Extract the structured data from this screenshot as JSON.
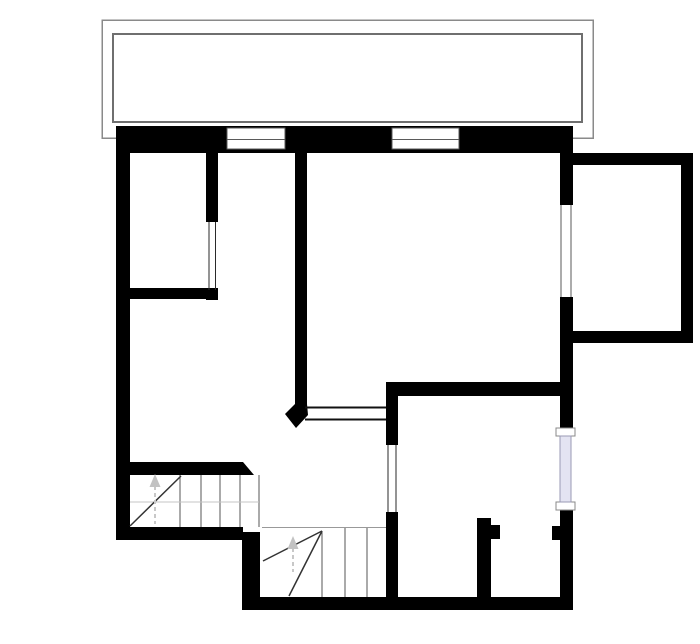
{
  "document": {
    "kind": "floor-plan-drawing",
    "canvas": {
      "width": 700,
      "height": 644
    }
  },
  "colors": {
    "wall": "#000000",
    "background": "#ffffff",
    "balcony_outline_outer": "#8a8a8a",
    "balcony_outline_inner": "#6f6f6f",
    "window_frame_line": "#5a5a5a",
    "opening_line": "#2a2a2a",
    "stair_tread_line": "#555555",
    "stair_diagonal_line": "#333333",
    "guide_line": "#c4c4c4",
    "arrow": "#c2c2c2",
    "glass_fill": "#e4e4f2",
    "glass_border": "#9a9ab4",
    "white": "#ffffff"
  },
  "plan": {
    "shapes": [
      {
        "type": "rect",
        "name": "balcony-outer-outline",
        "x": 102,
        "y": 20,
        "w": 491,
        "h": 118,
        "fill": "none",
        "stroke": "#8a8a8a",
        "sw": 1.5
      },
      {
        "type": "rect",
        "name": "balcony-inner-outline",
        "x": 113,
        "y": 34,
        "w": 469,
        "h": 88,
        "fill": "none",
        "stroke": "#6f6f6f",
        "sw": 2
      },
      {
        "type": "rect",
        "name": "wall-top-exterior",
        "x": 116,
        "y": 126,
        "w": 457,
        "h": 27,
        "fill": "#000000"
      },
      {
        "type": "rect",
        "name": "wall-left-exterior",
        "x": 116,
        "y": 126,
        "w": 14,
        "h": 414,
        "fill": "#000000"
      },
      {
        "type": "rect",
        "name": "wall-bottom-left",
        "x": 116,
        "y": 527,
        "w": 127,
        "h": 13,
        "fill": "#000000"
      },
      {
        "type": "rect",
        "name": "wall-stair-drop",
        "x": 242,
        "y": 532,
        "w": 18,
        "h": 78,
        "fill": "#000000"
      },
      {
        "type": "rect",
        "name": "wall-bottom-lower",
        "x": 242,
        "y": 597,
        "w": 331,
        "h": 13,
        "fill": "#000000"
      },
      {
        "type": "rect",
        "name": "wall-right-upper",
        "x": 560,
        "y": 153,
        "w": 13,
        "h": 52,
        "fill": "#000000"
      },
      {
        "type": "rect",
        "name": "wall-right-middle",
        "x": 560,
        "y": 297,
        "w": 13,
        "h": 131,
        "fill": "#000000"
      },
      {
        "type": "rect",
        "name": "wall-right-lower",
        "x": 560,
        "y": 510,
        "w": 13,
        "h": 100,
        "fill": "#000000"
      },
      {
        "type": "rect",
        "name": "wall-extension-top",
        "x": 573,
        "y": 153,
        "w": 120,
        "h": 12,
        "fill": "#000000"
      },
      {
        "type": "rect",
        "name": "wall-extension-right",
        "x": 681,
        "y": 153,
        "w": 12,
        "h": 190,
        "fill": "#000000"
      },
      {
        "type": "rect",
        "name": "wall-extension-bottom",
        "x": 573,
        "y": 331,
        "w": 120,
        "h": 12,
        "fill": "#000000"
      },
      {
        "type": "rect",
        "name": "wall-topleft-room-right",
        "x": 206,
        "y": 153,
        "w": 12,
        "h": 69,
        "fill": "#000000"
      },
      {
        "type": "rect",
        "name": "wall-topleft-room-bottom",
        "x": 128,
        "y": 288,
        "w": 90,
        "h": 11,
        "fill": "#000000"
      },
      {
        "type": "rect",
        "name": "wall-topleft-room-endcap",
        "x": 206,
        "y": 288,
        "w": 12,
        "h": 12,
        "fill": "#000000"
      },
      {
        "type": "rect",
        "name": "wall-central",
        "x": 295,
        "y": 153,
        "w": 12,
        "h": 252,
        "fill": "#000000"
      },
      {
        "type": "rect",
        "name": "wall-bottomright-room-top",
        "x": 386,
        "y": 382,
        "w": 187,
        "h": 14,
        "fill": "#000000"
      },
      {
        "type": "rect",
        "name": "wall-bottomright-left-upper",
        "x": 386,
        "y": 396,
        "w": 12,
        "h": 49,
        "fill": "#000000"
      },
      {
        "type": "rect",
        "name": "wall-bottomright-left-lower",
        "x": 386,
        "y": 512,
        "w": 12,
        "h": 97,
        "fill": "#000000"
      },
      {
        "type": "rect",
        "name": "wall-partition",
        "x": 477,
        "y": 518,
        "w": 14,
        "h": 85,
        "fill": "#000000"
      },
      {
        "type": "rect",
        "name": "wall-partition-stub",
        "x": 491,
        "y": 525,
        "w": 9,
        "h": 14,
        "fill": "#000000"
      },
      {
        "type": "rect",
        "name": "wall-right-stub",
        "x": 552,
        "y": 526,
        "w": 10,
        "h": 14,
        "fill": "#000000"
      },
      {
        "type": "rect",
        "name": "wall-stair-top",
        "x": 128,
        "y": 462,
        "w": 115,
        "h": 13,
        "fill": "#000000"
      },
      {
        "type": "polygon",
        "name": "wall-stair-top-chamfer",
        "points": "243,462 254,475 243,475",
        "fill": "#000000"
      },
      {
        "type": "polygon",
        "name": "wall-central-tip",
        "points": "295,404 307,404 308,415 296,428 285,414",
        "fill": "#000000"
      },
      {
        "type": "rect",
        "name": "window-top-1-frame",
        "x": 227,
        "y": 128,
        "w": 58,
        "h": 21,
        "fill": "#ffffff",
        "stroke": "#5a5a5a",
        "sw": 1
      },
      {
        "type": "line",
        "name": "window-top-1-sill",
        "x1": 227,
        "y1": 139.5,
        "x2": 285,
        "y2": 139.5,
        "stroke": "#5a5a5a",
        "sw": 1
      },
      {
        "type": "rect",
        "name": "window-top-2-frame",
        "x": 392,
        "y": 128,
        "w": 67,
        "h": 21,
        "fill": "#ffffff",
        "stroke": "#5a5a5a",
        "sw": 1
      },
      {
        "type": "line",
        "name": "window-top-2-sill",
        "x1": 392,
        "y1": 139.5,
        "x2": 459,
        "y2": 139.5,
        "stroke": "#5a5a5a",
        "sw": 1
      },
      {
        "type": "rect",
        "name": "window-right-extension-gap",
        "x": 558,
        "y": 205,
        "w": 17,
        "h": 92,
        "fill": "#ffffff"
      },
      {
        "type": "line",
        "name": "window-right-extension-line-left",
        "x1": 561,
        "y1": 205,
        "x2": 561,
        "y2": 297,
        "stroke": "#5a5a5a",
        "sw": 1.2
      },
      {
        "type": "line",
        "name": "window-right-extension-line-right",
        "x1": 571,
        "y1": 205,
        "x2": 571,
        "y2": 297,
        "stroke": "#5a5a5a",
        "sw": 1.2
      },
      {
        "type": "rect",
        "name": "window-right-lavender-cap-top",
        "x": 556,
        "y": 428,
        "w": 19,
        "h": 8,
        "fill": "#ffffff",
        "stroke": "#888888",
        "sw": 1
      },
      {
        "type": "rect",
        "name": "window-right-lavender-cap-bottom",
        "x": 556,
        "y": 502,
        "w": 19,
        "h": 8,
        "fill": "#ffffff",
        "stroke": "#888888",
        "sw": 1
      },
      {
        "type": "rect",
        "name": "window-right-lavender-glass",
        "x": 560,
        "y": 436,
        "w": 11,
        "h": 66,
        "fill": "#e4e4f2",
        "stroke": "#9a9ab4",
        "sw": 1
      },
      {
        "type": "line",
        "name": "opening-topleft-room-line-left",
        "x1": 209,
        "y1": 222,
        "x2": 209,
        "y2": 290,
        "stroke": "#2a2a2a",
        "sw": 1.2
      },
      {
        "type": "line",
        "name": "opening-topleft-room-line-right",
        "x1": 215.5,
        "y1": 222,
        "x2": 215.5,
        "y2": 290,
        "stroke": "#2a2a2a",
        "sw": 1.2
      },
      {
        "type": "line",
        "name": "opening-passthrough-line-top",
        "x1": 305,
        "y1": 407.5,
        "x2": 386,
        "y2": 407.5,
        "stroke": "#111111",
        "sw": 2
      },
      {
        "type": "line",
        "name": "opening-passthrough-line-bottom",
        "x1": 305,
        "y1": 419.5,
        "x2": 386,
        "y2": 419.5,
        "stroke": "#111111",
        "sw": 2
      },
      {
        "type": "line",
        "name": "opening-bottomright-line-left",
        "x1": 388,
        "y1": 445,
        "x2": 388,
        "y2": 512,
        "stroke": "#2a2a2a",
        "sw": 1.2
      },
      {
        "type": "line",
        "name": "opening-bottomright-line-right",
        "x1": 396,
        "y1": 445,
        "x2": 396,
        "y2": 512,
        "stroke": "#2a2a2a",
        "sw": 1.2
      },
      {
        "type": "line",
        "name": "stair-upper-tread-1",
        "x1": 180,
        "y1": 475,
        "x2": 180,
        "y2": 527,
        "stroke": "#555555",
        "sw": 1
      },
      {
        "type": "line",
        "name": "stair-upper-tread-2",
        "x1": 201,
        "y1": 475,
        "x2": 201,
        "y2": 527,
        "stroke": "#555555",
        "sw": 1
      },
      {
        "type": "line",
        "name": "stair-upper-tread-3",
        "x1": 220,
        "y1": 475,
        "x2": 220,
        "y2": 527,
        "stroke": "#555555",
        "sw": 1
      },
      {
        "type": "line",
        "name": "stair-upper-tread-4",
        "x1": 240,
        "y1": 475,
        "x2": 240,
        "y2": 527,
        "stroke": "#555555",
        "sw": 1
      },
      {
        "type": "line",
        "name": "stair-upper-tread-5",
        "x1": 259,
        "y1": 475,
        "x2": 259,
        "y2": 527,
        "stroke": "#555555",
        "sw": 1
      },
      {
        "type": "line",
        "name": "stair-upper-guide",
        "x1": 130,
        "y1": 502,
        "x2": 259,
        "y2": 502,
        "stroke": "#c4c4c4",
        "sw": 1
      },
      {
        "type": "line",
        "name": "stair-upper-winder-diagonal",
        "x1": 130,
        "y1": 526,
        "x2": 181,
        "y2": 476,
        "stroke": "#333333",
        "sw": 1.5
      },
      {
        "type": "line",
        "name": "stair-upper-arrow-stem",
        "x1": 155,
        "y1": 486,
        "x2": 155,
        "y2": 524,
        "stroke": "#c8c8c8",
        "sw": 2,
        "dash": "4 3"
      },
      {
        "type": "polygon",
        "name": "stair-upper-arrow-head",
        "points": "155,474 149.5,487 160.5,487",
        "fill": "#c2c2c2"
      },
      {
        "type": "line",
        "name": "stair-lower-boundary",
        "x1": 262,
        "y1": 527.5,
        "x2": 386,
        "y2": 527.5,
        "stroke": "#999999",
        "sw": 1
      },
      {
        "type": "line",
        "name": "stair-lower-tread-1",
        "x1": 322,
        "y1": 531,
        "x2": 322,
        "y2": 597,
        "stroke": "#555555",
        "sw": 1
      },
      {
        "type": "line",
        "name": "stair-lower-tread-2",
        "x1": 345,
        "y1": 528,
        "x2": 345,
        "y2": 597,
        "stroke": "#555555",
        "sw": 1
      },
      {
        "type": "line",
        "name": "stair-lower-tread-3",
        "x1": 367,
        "y1": 528,
        "x2": 367,
        "y2": 597,
        "stroke": "#555555",
        "sw": 1
      },
      {
        "type": "line",
        "name": "stair-lower-winder-diagonal-1",
        "x1": 322,
        "y1": 531,
        "x2": 263,
        "y2": 561,
        "stroke": "#333333",
        "sw": 1.5
      },
      {
        "type": "line",
        "name": "stair-lower-winder-diagonal-2",
        "x1": 322,
        "y1": 531,
        "x2": 289,
        "y2": 596,
        "stroke": "#333333",
        "sw": 1.5
      },
      {
        "type": "line",
        "name": "stair-lower-arrow-stem",
        "x1": 293,
        "y1": 548,
        "x2": 293,
        "y2": 572,
        "stroke": "#c8c8c8",
        "sw": 2,
        "dash": "4 3"
      },
      {
        "type": "polygon",
        "name": "stair-lower-arrow-head",
        "points": "293,536 287.5,549 298.5,549",
        "fill": "#c2c2c2"
      }
    ]
  }
}
